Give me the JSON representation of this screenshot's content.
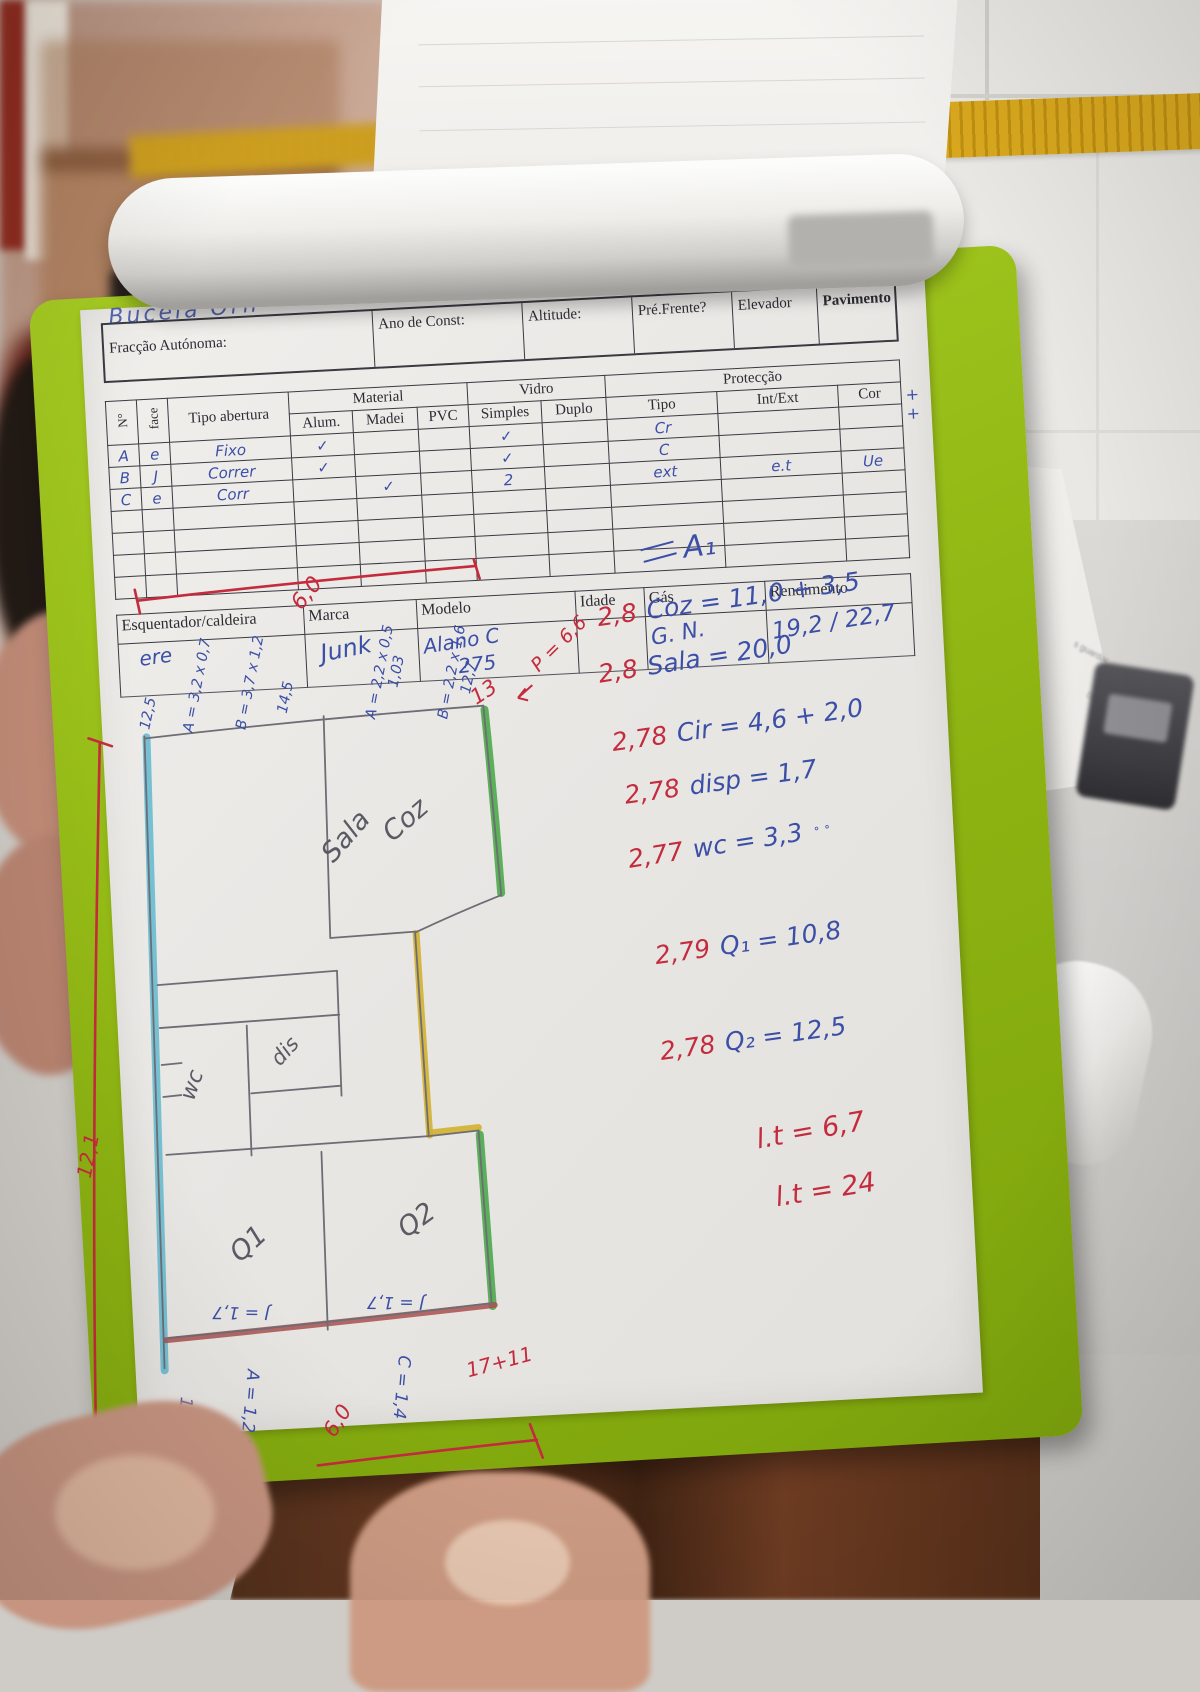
{
  "form": {
    "title_scribble": "Bucela Orh",
    "header_fields": [
      "Fracção Autónoma:",
      "Ano de Const:",
      "Altitude:",
      "Pré.Frente?",
      "Elevador",
      "Pavimento e Cobertura"
    ],
    "openings": {
      "no": "N°",
      "face": "face",
      "tipo": "Tipo abertura",
      "material": "Material",
      "alum": "Alum.",
      "madei": "Madei",
      "pvc": "PVC",
      "vidro": "Vidro",
      "simples": "Simples",
      "duplo": "Duplo",
      "proteccao": "Protecção",
      "ptipo": "Tipo",
      "intext": "Int/Ext",
      "cor": "Cor",
      "rows": [
        {
          "no": "A",
          "face": "e",
          "tipo": "Fixo",
          "alum": "✓",
          "madei": "",
          "pvc": "",
          "simples": "✓",
          "duplo": "",
          "ptipo": "Cr",
          "intext": "",
          "cor": ""
        },
        {
          "no": "B",
          "face": "J",
          "tipo": "Correr",
          "alum": "✓",
          "madei": "",
          "pvc": "",
          "simples": "✓",
          "duplo": "",
          "ptipo": "C",
          "intext": "",
          "cor": ""
        },
        {
          "no": "C",
          "face": "e",
          "tipo": "Corr",
          "alum": "",
          "madei": "✓",
          "pvc": "",
          "simples": "2",
          "duplo": "",
          "ptipo": "ext",
          "intext": "e.t",
          "cor": "Ue"
        }
      ],
      "margin_note": "+ +"
    },
    "heater": {
      "headers": [
        "Esquentador/caldeira",
        "Marca",
        "Modelo",
        "Idade",
        "Gás",
        "Rendimento"
      ],
      "values": {
        "name": "ere",
        "marca": "Junk",
        "modelo": "Alano C",
        "modelo2": "275",
        "idade": "",
        "gas": "G. N.",
        "rendimento": "19,2 / 22,7"
      }
    }
  },
  "calc": {
    "title": "A₁",
    "lines": [
      {
        "coef": "2,8",
        "expr": "Coz = 11,0 + 3,5"
      },
      {
        "coef": "2,8",
        "expr": "Sala = 20,0"
      },
      {
        "coef": "2,78",
        "expr": "Cir = 4,6 + 2,0"
      },
      {
        "coef": "2,78",
        "expr": "disp = 1,7"
      },
      {
        "coef": "2,77",
        "expr": "wc = 3,3",
        "note": "˚ ˚"
      },
      {
        "coef": "2,79",
        "expr": "Q₁ = 10,8"
      },
      {
        "coef": "2,78",
        "expr": "Q₂ = 12,5"
      }
    ],
    "totals": [
      "l.t = 6,7",
      "l.t = 24"
    ]
  },
  "plan": {
    "rooms": {
      "sala": "Sala",
      "coz": "Coz",
      "wc": "wc",
      "disp": "dis",
      "q1": "Q1",
      "q2": "Q2"
    },
    "dims_top": [
      "12,5",
      "A = 3,2 x 0,7",
      "B = 3,7 x 1,2",
      "14,5",
      "A = 2,2 x 0,5",
      "1,03",
      "B = 2,2 x 1,6",
      "12,7"
    ],
    "dim_top_red": "6,0",
    "dim_left_red": "12,1",
    "red_13": "13",
    "red_perimeter": "P = 6,6",
    "window_q1": "J = 1,7",
    "window_q2": "J = 1,7",
    "dims_bottom": [
      "1,4",
      "A = 1,2 x 1,2",
      "C = 1,4"
    ],
    "dim_bottom_red": "6,0",
    "dim_bottom_sum": "17+11"
  },
  "background": {
    "scrap_text_1": "s guardar",
    "scrap_text_2": "DocProcCert v.5"
  }
}
